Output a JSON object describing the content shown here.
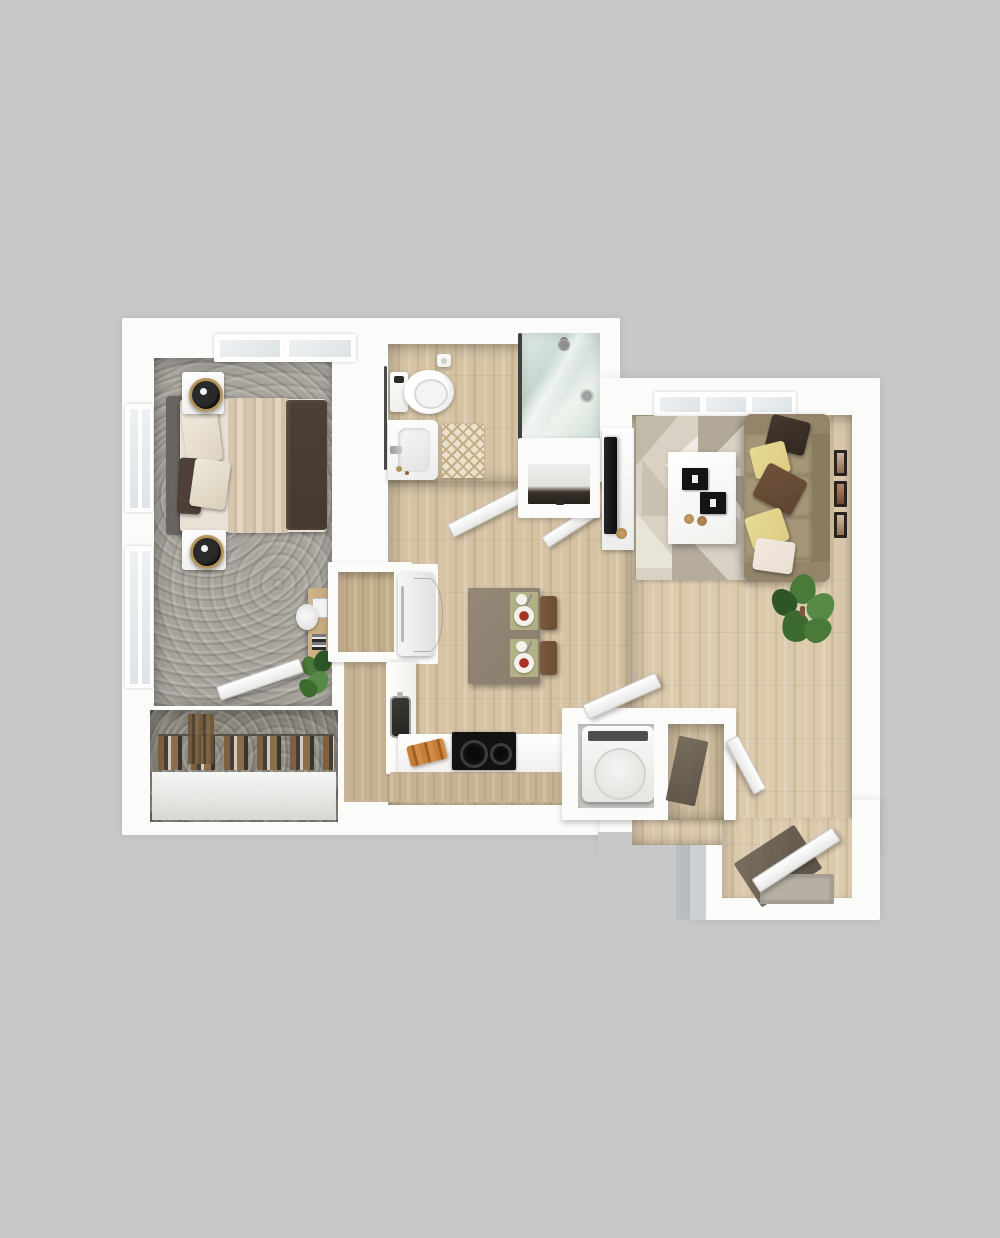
{
  "scene": {
    "kind": "3d-floorplan-render-top-view",
    "rooms": [
      {
        "name": "bedroom",
        "floor": "gray-carpet",
        "furniture": [
          "bed-with-dark-throw",
          "nightstand-left-top",
          "nightstand-left-bottom",
          "table-lamp-x2",
          "desk-with-plant",
          "wall-windows-x2",
          "transom-window"
        ]
      },
      {
        "name": "walk-in-closet",
        "floor": "gray-carpet",
        "furniture": [
          "hanging-clothes-rod"
        ]
      },
      {
        "name": "bathroom",
        "floor": "wood-plank",
        "furniture": [
          "toilet",
          "vanity-sink",
          "bath-mat-lattice",
          "glass-shower",
          "towel-bar",
          "toilet-paper-holder"
        ]
      },
      {
        "name": "hallway",
        "floor": "wood-plank",
        "furniture": [
          "open-door-x2",
          "linen-closet"
        ]
      },
      {
        "name": "kitchen-dining",
        "floor": "wood-plank",
        "furniture": [
          "pantry-nook",
          "refrigerator",
          "l-shaped-counter",
          "sink",
          "cooktop-2-burner",
          "cutting-board",
          "dining-table",
          "dining-chair-x2",
          "place-setting-x2"
        ]
      },
      {
        "name": "laundry-closet",
        "floor": "wood-plank",
        "furniture": [
          "top-load-washer",
          "storage-compartment",
          "open-door-x2"
        ]
      },
      {
        "name": "living-room",
        "floor": "wood-plank",
        "furniture": [
          "sofa-with-5-pillows",
          "geometric-rug",
          "coffee-table-with-books",
          "tv-on-media-console",
          "gallery-frames-x3",
          "potted-plant",
          "window"
        ]
      },
      {
        "name": "entry",
        "floor": "wood-plank",
        "furniture": [
          "front-door-open",
          "doormat"
        ]
      }
    ]
  },
  "colors": {
    "bg": "#c8c8c8",
    "wall": "#fbfbfa",
    "wood": "#d5c3a4",
    "woodLight": "#dccaad",
    "carpet": "#a8a49d",
    "carpetDark": "#8d897f",
    "counterTan": "#c6b394",
    "pantryTan": "#c3ae8c",
    "tableTaupe": "#8a7d6f",
    "chairBrown": "#6a4e33",
    "sofaBase": "#9c8d70",
    "sofaSeat": "#a59677",
    "pillowDark": "#32281f",
    "pillowYellow": "#ddcc82",
    "pillowBrown": "#5e4532",
    "pillowBlush": "#eadfd3",
    "bedHeadboard": "#68645f",
    "bedLinen": "#e9e1d3",
    "bedDrape": "#d8c7b0",
    "bedFoot": "#46392f",
    "applianceBlack": "#121212",
    "lampGold": "#b3955c",
    "matCream": "#e9e1cd",
    "matLattice": "#c3ad83",
    "glassTeal": "#c9d8d1",
    "plantGreen": "#4a7a3a",
    "plantGreenDark": "#2f5527",
    "shadowExterior": "#b2b8bf",
    "doormatGray": "#b5afa4",
    "entryShadow": "#60564a"
  }
}
